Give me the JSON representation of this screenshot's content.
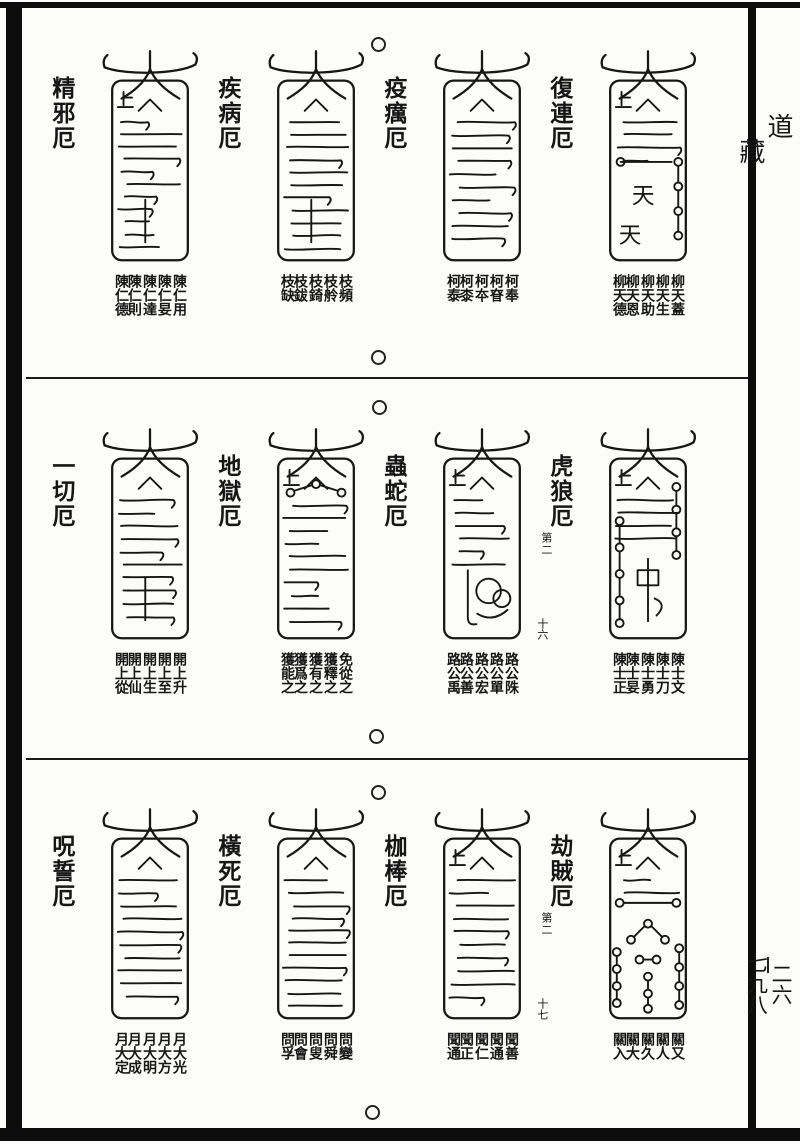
{
  "margin": {
    "canon_char_1": "道",
    "canon_char_2": "藏",
    "volume_no": "二六",
    "page_no": "七九八"
  },
  "rows": [
    {
      "talismans": [
        {
          "label": "精邪厄",
          "motif": "lines",
          "names": [
            [
              "陳仁用",
              "陳仁妟"
            ],
            [
              "陳仁達",
              "陳仁則"
            ],
            [
              "陳仁德"
            ]
          ]
        },
        {
          "label": "疾病厄",
          "motif": "lines",
          "names": [
            [
              "枝頻",
              "枝舲"
            ],
            [
              "枝錡",
              "枝鈸"
            ],
            [
              "枝缺"
            ]
          ]
        },
        {
          "label": "疫癘厄",
          "motif": "lines",
          "names": [
            [
              "柯奉",
              "柯眘"
            ],
            [
              "柯夲",
              "柯桼"
            ],
            [
              "柯泰"
            ]
          ]
        },
        {
          "label": "復連厄",
          "motif": "stars",
          "glyphs": "天天",
          "names": [
            [
              "柳天蓋",
              "柳天生"
            ],
            [
              "柳天助",
              "柳天恩"
            ],
            [
              "柳天德"
            ]
          ]
        }
      ]
    },
    {
      "talismans": [
        {
          "label": "一切厄",
          "motif": "lines",
          "names": [
            [
              "開上升",
              "開上至"
            ],
            [
              "開上生",
              "開上仙"
            ],
            [
              "開上從"
            ]
          ]
        },
        {
          "label": "地獄厄",
          "motif": "dots",
          "names": [
            [
              "免從之",
              "獲釋之"
            ],
            [
              "獲有之",
              "獲爲之"
            ],
            [
              "獲能之"
            ]
          ]
        },
        {
          "label": "蟲蛇厄",
          "motif": "snake",
          "folio": "十六",
          "names": [
            [
              "路公陎",
              "路公單"
            ],
            [
              "路公宏",
              "路公善"
            ],
            [
              "路公禹"
            ]
          ]
        },
        {
          "label": "虎狼厄",
          "motif": "chains",
          "note": "第二",
          "names": [
            [
              "陳士文",
              "陳士刀"
            ],
            [
              "陳士勇",
              "陳士妟"
            ],
            [
              "陳士正"
            ]
          ]
        }
      ]
    },
    {
      "talismans": [
        {
          "label": "呪誓厄",
          "motif": "lines",
          "names": [
            [
              "月大光",
              "月大方"
            ],
            [
              "月大明",
              "月大成"
            ],
            [
              "月大定"
            ]
          ]
        },
        {
          "label": "橫死厄",
          "motif": "lines",
          "names": [
            [
              "問變",
              "問舜"
            ],
            [
              "問叟",
              "問會"
            ],
            [
              "問孚"
            ]
          ]
        },
        {
          "label": "枷棒厄",
          "motif": "lines",
          "folio": "十七",
          "names": [
            [
              "聞善",
              "聞通"
            ],
            [
              "聞仁",
              "聞正"
            ],
            [
              "聞通"
            ]
          ]
        },
        {
          "label": "劫賊厄",
          "motif": "heavy",
          "note": "第二",
          "names": [
            [
              "關又",
              "關人"
            ],
            [
              "關久",
              "關大"
            ],
            [
              "關入"
            ]
          ]
        }
      ]
    }
  ],
  "ink_color": "#161616",
  "paper_color": "#fcfcfa"
}
